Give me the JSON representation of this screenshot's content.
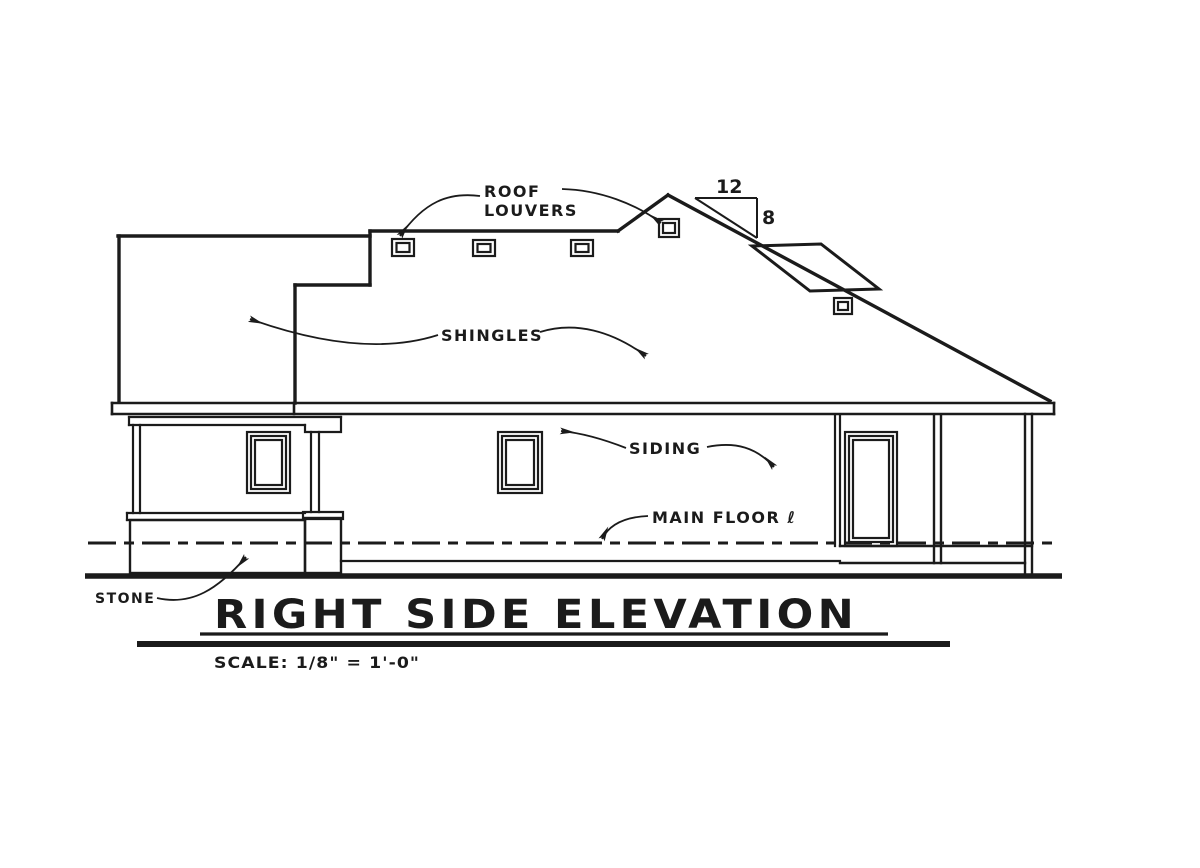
{
  "drawing": {
    "title": "RIGHT SIDE ELEVATION",
    "scale_note": "SCALE: 1/8\" = 1'-0\"",
    "annotations": {
      "roof_louvers_line1": "ROOF",
      "roof_louvers_line2": "LOUVERS",
      "shingles": "SHINGLES",
      "siding": "SIDING",
      "main_floor": "MAIN FLOOR ℓ",
      "stone": "STONE"
    },
    "pitch": {
      "run": "12",
      "rise": "8"
    },
    "ink_color": "#1b1b1b",
    "background": "#ffffff"
  }
}
